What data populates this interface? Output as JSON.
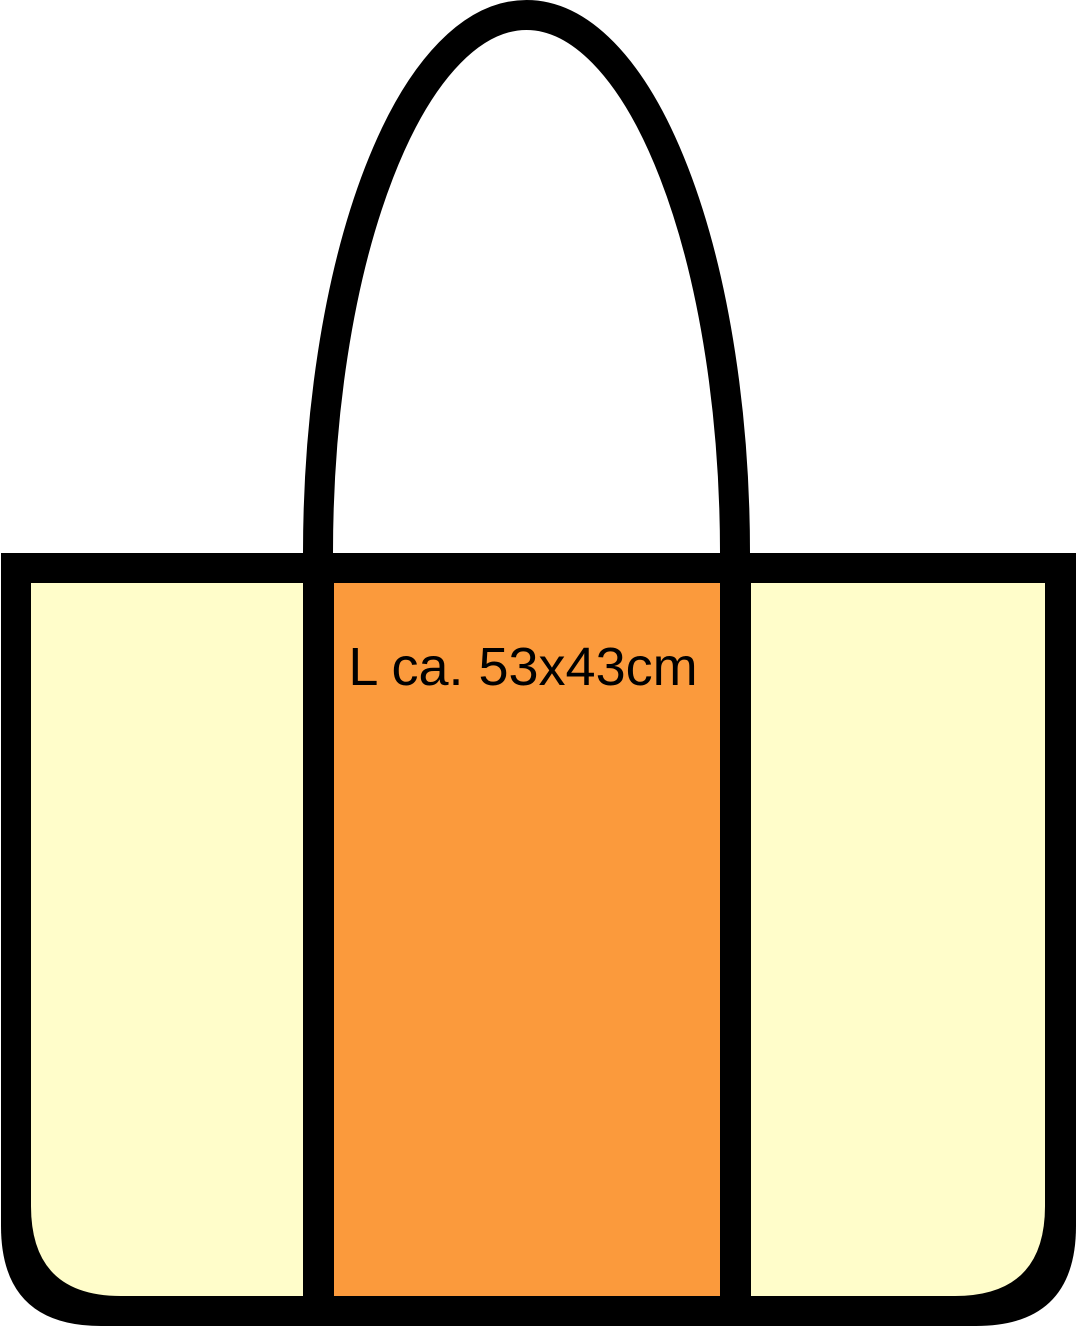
{
  "illustration": {
    "subject": "tote-bag-size-diagram",
    "size_label": "L ca. 53x43cm"
  },
  "colors": {
    "outline": "#000000",
    "panel_cream": "#FFFDCA",
    "panel_orange": "#FB9A3C",
    "label_text": "#000000",
    "background": "#FFFFFF"
  }
}
